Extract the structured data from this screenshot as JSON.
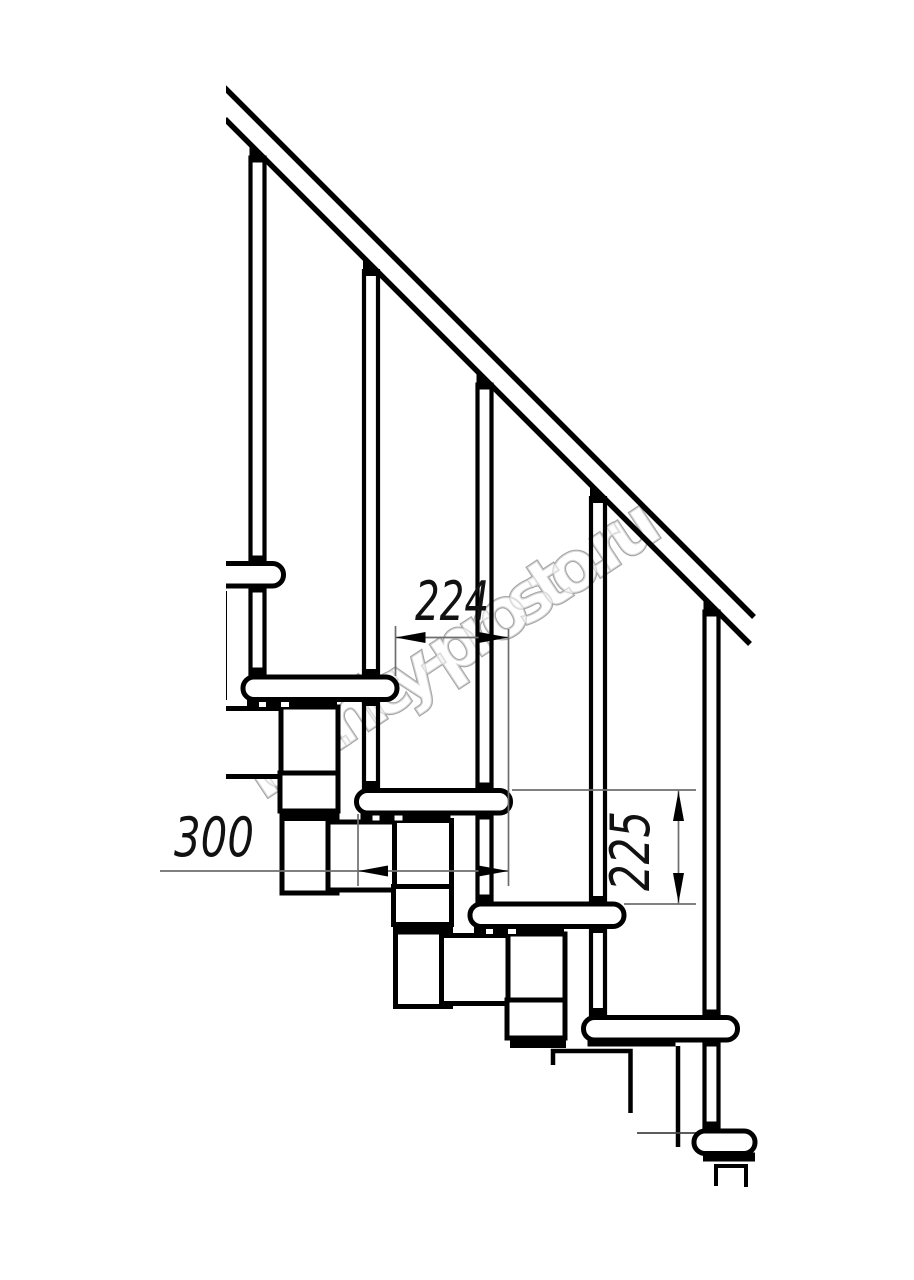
{
  "watermark": {
    "text": "lestnicy-prosto.ru"
  },
  "dimensions": {
    "tread_overlap": {
      "value": "224"
    },
    "tread_depth": {
      "value": "300"
    },
    "step_rise": {
      "value": "225"
    }
  },
  "colors": {
    "line": "#000000",
    "dimension_line": "#6e6e6e",
    "watermark_outline": "#a5a5a5",
    "background": "#ffffff"
  }
}
